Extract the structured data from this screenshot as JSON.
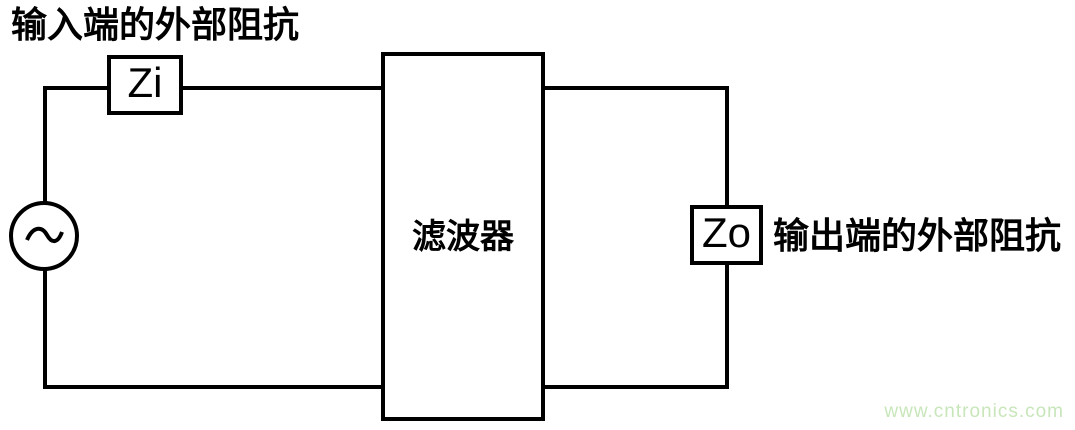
{
  "diagram": {
    "input_caption": "输入端的外部阻抗",
    "zi_label": "Zi",
    "filter_label": "滤波器",
    "zo_label": "Zo",
    "output_caption": "输出端的外部阻抗",
    "watermark": "www.cntronics.com",
    "icons": {
      "ac_source": "sine-wave-in-circle"
    },
    "colors": {
      "line": "#000000",
      "background": "#ffffff",
      "watermark": "#c8e6ba"
    }
  }
}
